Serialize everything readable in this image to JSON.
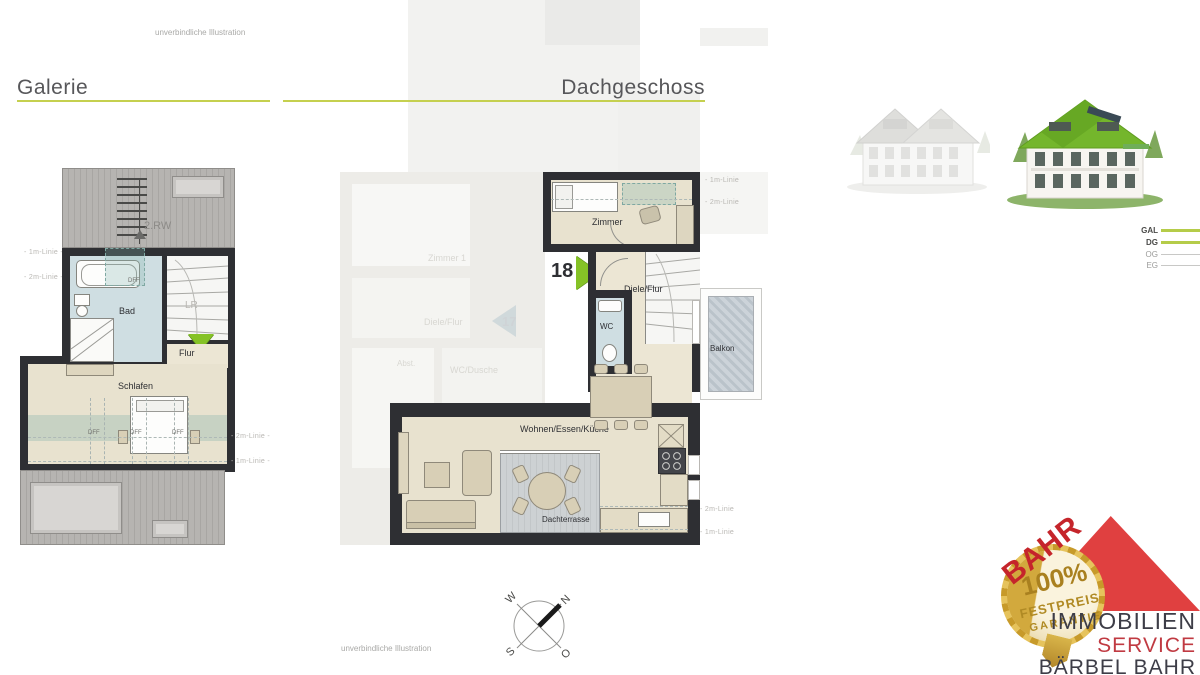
{
  "meta": {
    "disclaimer_top": "unverbindliche Illustration",
    "disclaimer_bottom": "unverbindliche Illustration"
  },
  "headings": {
    "galerie": "Galerie",
    "dachgeschoss": "Dachgeschoss"
  },
  "galerie": {
    "escape_route": "2.RW",
    "bad": "Bad",
    "lr": "LR",
    "flur": "Flur",
    "schlafen": "Schlafen",
    "dff_bath": "DFF",
    "dff": [
      "DFF",
      "DFF",
      "DFF"
    ],
    "line_left_1m": "- 1m-Linie -",
    "line_left_2m": "- 2m-Linie -",
    "line_right_2m": "- 2m-Linie -",
    "line_right_1m": "- 1m-Linie -"
  },
  "dach": {
    "unit_number": "18",
    "zimmer": "Zimmer",
    "diele": "Diele/Flur",
    "wc": "WC",
    "balkon": "Balkon",
    "wohnen": "Wohnen/Essen/Küche",
    "terrasse": "Dachterrasse",
    "line_top_1m": "- 1m-Linie",
    "line_top_2m": "- 2m-Linie",
    "line_bottom_2m": "- 2m-Linie",
    "line_bottom_1m": "- 1m-Linie"
  },
  "ghost": {
    "zimmer1": "Zimmer 1",
    "diele": "Diele/Flur",
    "abst": "Abst.",
    "wc_dusche": "WC/Dusche",
    "unit_number": "17"
  },
  "legend": {
    "items": [
      {
        "label": "GAL",
        "active": true
      },
      {
        "label": "DG",
        "active": true
      },
      {
        "label": "OG",
        "active": false
      },
      {
        "label": "EG",
        "active": false
      }
    ]
  },
  "compass": {
    "n": "N",
    "o": "O",
    "s": "S",
    "w": "W"
  },
  "logo": {
    "brand": "BAHR",
    "seal_percent": "100%",
    "seal_line1": "FESTPREIS",
    "seal_line2": "GARANTIE",
    "line1": "IMMOBILIEN",
    "line2": "SERVICE",
    "line3": "BÄRBEL BAHR"
  },
  "colors": {
    "accent_green": "#c5d04f",
    "legend_green": "#b5cc49",
    "marker_green": "#85c226",
    "logo_red": "#e04040",
    "brand_red": "#c5252b",
    "service_red": "#c03a42",
    "text_dark": "#3d3d47",
    "wall": "#2e2f33",
    "floor": "#e8e2cf",
    "bath_blue": "#cfdee2",
    "roof_gray": "#b4b2af",
    "gold": "#c9a23a"
  }
}
